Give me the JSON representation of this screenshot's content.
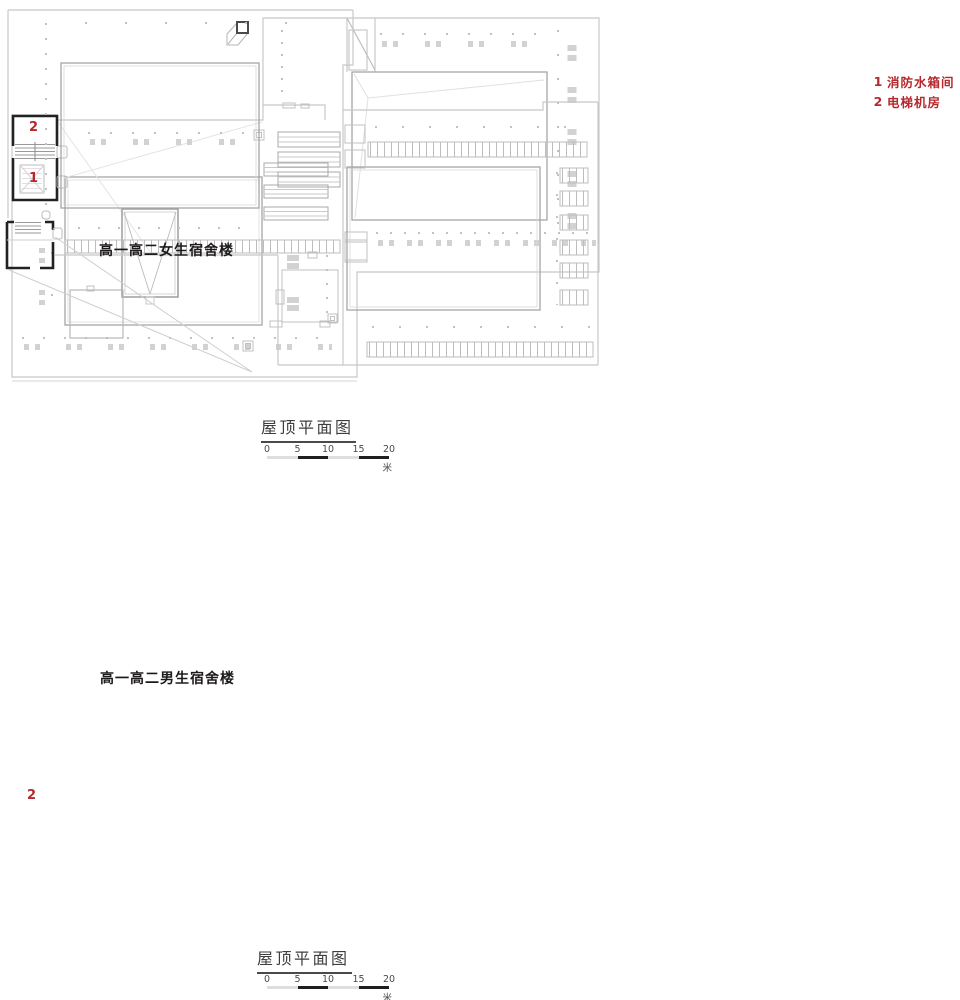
{
  "legend": {
    "color": "#b5282d",
    "items": [
      {
        "num": "1",
        "label": "消防水箱间"
      },
      {
        "num": "2",
        "label": "电梯机房"
      }
    ]
  },
  "plan_top": {
    "building_label": "高一高二女生宿舍楼",
    "markers": {
      "elevator": "2",
      "tank": "1"
    },
    "title": "屋顶平面图",
    "scale_bar": {
      "ticks": [
        "0",
        "5",
        "10",
        "15",
        "20"
      ],
      "unit": "米"
    }
  },
  "plan_bottom": {
    "building_label": "高一高二男生宿舍楼",
    "markers": {
      "elevator": "2"
    },
    "title": "屋顶平面图",
    "scale_bar": {
      "ticks": [
        "0",
        "5",
        "10",
        "15",
        "20"
      ],
      "unit": "米"
    }
  },
  "colors": {
    "marker_red": "#b5282d",
    "line_light": "#c8c8c8",
    "line_mid": "#a6a6a6",
    "line_dark": "#222222",
    "paper": "#ffffff"
  }
}
